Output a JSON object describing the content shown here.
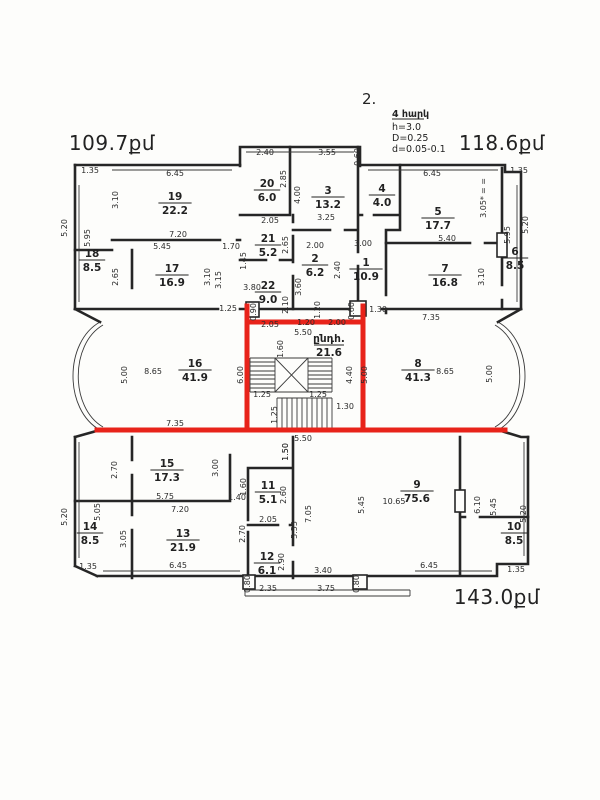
{
  "meta": {
    "floor_mark": "2."
  },
  "notes": {
    "title": "4 հարկ",
    "line_h": "h=3.0",
    "line_D": "D=0.25",
    "line_d": "d=0.05-0.1"
  },
  "hall": {
    "num": "ընդհ.",
    "area": "21.6"
  },
  "colors": {
    "ink": "#262626",
    "highlight_red": "#e8231a",
    "paper": "#fdfdfb"
  },
  "area_labels": [
    {
      "text": "109.7քմ",
      "x": 112,
      "y": 150
    },
    {
      "text": "118.6քմ",
      "x": 502,
      "y": 150
    },
    {
      "text": "143.0քմ",
      "x": 497,
      "y": 604
    }
  ],
  "rooms": [
    {
      "num": "19",
      "area": "22.2",
      "x": 175,
      "y": 203
    },
    {
      "num": "20",
      "area": "6.0",
      "x": 267,
      "y": 190
    },
    {
      "num": "3",
      "area": "13.2",
      "x": 328,
      "y": 197
    },
    {
      "num": "4",
      "area": "4.0",
      "x": 382,
      "y": 195
    },
    {
      "num": "5",
      "area": "17.7",
      "x": 438,
      "y": 218
    },
    {
      "num": "18",
      "area": "8.5",
      "x": 92,
      "y": 260
    },
    {
      "num": "17",
      "area": "16.9",
      "x": 172,
      "y": 275
    },
    {
      "num": "21",
      "area": "5.2",
      "x": 268,
      "y": 245
    },
    {
      "num": "2",
      "area": "6.2",
      "x": 315,
      "y": 265
    },
    {
      "num": "1",
      "area": "10.9",
      "x": 366,
      "y": 269
    },
    {
      "num": "7",
      "area": "16.8",
      "x": 445,
      "y": 275
    },
    {
      "num": "6",
      "area": "8.5",
      "x": 515,
      "y": 258
    },
    {
      "num": "22",
      "area": "9.0",
      "x": 268,
      "y": 292
    },
    {
      "num": "16",
      "area": "41.9",
      "x": 195,
      "y": 370
    },
    {
      "num": "8",
      "area": "41.3",
      "x": 418,
      "y": 370
    },
    {
      "num": "15",
      "area": "17.3",
      "x": 167,
      "y": 470
    },
    {
      "num": "11",
      "area": "5.1",
      "x": 268,
      "y": 492
    },
    {
      "num": "9",
      "area": "75.6",
      "x": 417,
      "y": 491
    },
    {
      "num": "14",
      "area": "8.5",
      "x": 90,
      "y": 533
    },
    {
      "num": "13",
      "area": "21.9",
      "x": 183,
      "y": 540
    },
    {
      "num": "12",
      "area": "6.1",
      "x": 267,
      "y": 563
    },
    {
      "num": "10",
      "area": "8.5",
      "x": 514,
      "y": 533
    }
  ],
  "dims": [
    {
      "t": "1.35",
      "x": 90,
      "y": 173
    },
    {
      "t": "6.45",
      "x": 175,
      "y": 176
    },
    {
      "t": "3.10",
      "x": 118,
      "y": 200,
      "r": 1
    },
    {
      "t": "5.20",
      "x": 67,
      "y": 228,
      "r": 1
    },
    {
      "t": "7.20",
      "x": 178,
      "y": 237
    },
    {
      "t": "5.95",
      "x": 90,
      "y": 238,
      "r": 1
    },
    {
      "t": "5.45",
      "x": 162,
      "y": 249
    },
    {
      "t": "1.70",
      "x": 231,
      "y": 249
    },
    {
      "t": "2.65",
      "x": 118,
      "y": 277,
      "r": 1
    },
    {
      "t": "3.10",
      "x": 210,
      "y": 277,
      "r": 1
    },
    {
      "t": "3.15",
      "x": 221,
      "y": 280,
      "r": 1
    },
    {
      "t": "2.40",
      "x": 265,
      "y": 155
    },
    {
      "t": "3.55",
      "x": 327,
      "y": 155
    },
    {
      "t": "0.60",
      "x": 360,
      "y": 157,
      "r": 1
    },
    {
      "t": "2.85",
      "x": 286,
      "y": 179,
      "r": 1
    },
    {
      "t": "4.00",
      "x": 300,
      "y": 195,
      "r": 1
    },
    {
      "t": "2.05",
      "x": 270,
      "y": 223
    },
    {
      "t": "3.25",
      "x": 326,
      "y": 220
    },
    {
      "t": "2.65",
      "x": 288,
      "y": 245,
      "r": 1
    },
    {
      "t": "2.00",
      "x": 315,
      "y": 248
    },
    {
      "t": "3.00",
      "x": 363,
      "y": 246
    },
    {
      "t": "1.45",
      "x": 246,
      "y": 261,
      "r": 1
    },
    {
      "t": "3.80",
      "x": 252,
      "y": 290
    },
    {
      "t": "2.40",
      "x": 340,
      "y": 270,
      "r": 1
    },
    {
      "t": "3.60",
      "x": 301,
      "y": 287,
      "r": 1
    },
    {
      "t": "2.10",
      "x": 288,
      "y": 305,
      "r": 1
    },
    {
      "t": "1.20",
      "x": 320,
      "y": 310,
      "r": 1
    },
    {
      "t": "1.25",
      "x": 228,
      "y": 311
    },
    {
      "t": "0.90",
      "x": 256,
      "y": 312,
      "r": 1
    },
    {
      "t": "0.60",
      "x": 354,
      "y": 311,
      "r": 1
    },
    {
      "t": "2.05",
      "x": 270,
      "y": 327
    },
    {
      "t": "1.20",
      "x": 306,
      "y": 325
    },
    {
      "t": "2.00",
      "x": 337,
      "y": 325
    },
    {
      "t": "1.30",
      "x": 378,
      "y": 312
    },
    {
      "t": "6.45",
      "x": 432,
      "y": 176
    },
    {
      "t": "1.35",
      "x": 519,
      "y": 173
    },
    {
      "t": "= =",
      "x": 486,
      "y": 186,
      "r": 1
    },
    {
      "t": "3.05*",
      "x": 486,
      "y": 207,
      "r": 1
    },
    {
      "t": "5.20",
      "x": 528,
      "y": 225,
      "r": 1
    },
    {
      "t": "5.95",
      "x": 510,
      "y": 235,
      "r": 1
    },
    {
      "t": "5.40",
      "x": 447,
      "y": 241
    },
    {
      "t": "3.10",
      "x": 484,
      "y": 277,
      "r": 1
    },
    {
      "t": "7.35",
      "x": 431,
      "y": 320
    },
    {
      "t": "5.50",
      "x": 303,
      "y": 335
    },
    {
      "t": "1.60",
      "x": 283,
      "y": 349,
      "r": 1
    },
    {
      "t": "6.00",
      "x": 243,
      "y": 375,
      "r": 1
    },
    {
      "t": "5.00",
      "x": 127,
      "y": 375,
      "r": 1
    },
    {
      "t": "8.65",
      "x": 153,
      "y": 374
    },
    {
      "t": "5.00",
      "x": 367,
      "y": 375,
      "r": 1
    },
    {
      "t": "4.40",
      "x": 352,
      "y": 375,
      "r": 1
    },
    {
      "t": "8.65",
      "x": 445,
      "y": 374
    },
    {
      "t": "5.00",
      "x": 492,
      "y": 374,
      "r": 1
    },
    {
      "t": "1.25",
      "x": 262,
      "y": 397
    },
    {
      "t": "1.25",
      "x": 318,
      "y": 397
    },
    {
      "t": "1.25",
      "x": 277,
      "y": 415,
      "r": 1
    },
    {
      "t": "1.30",
      "x": 345,
      "y": 409
    },
    {
      "t": "7.35",
      "x": 175,
      "y": 426
    },
    {
      "t": "5.50",
      "x": 303,
      "y": 441
    },
    {
      "t": "1.50",
      "x": 288,
      "y": 452,
      "r": 1
    },
    {
      "t": "2.70",
      "x": 117,
      "y": 470,
      "r": 1
    },
    {
      "t": "3.00",
      "x": 218,
      "y": 468,
      "r": 1
    },
    {
      "t": "5.75",
      "x": 165,
      "y": 499
    },
    {
      "t": "1.40",
      "x": 237,
      "y": 500
    },
    {
      "t": "1.60",
      "x": 246,
      "y": 487,
      "r": 1
    },
    {
      "t": "5.20",
      "x": 67,
      "y": 517,
      "r": 1
    },
    {
      "t": "5.05",
      "x": 100,
      "y": 512,
      "r": 1
    },
    {
      "t": "7.20",
      "x": 180,
      "y": 512
    },
    {
      "t": "3.05",
      "x": 126,
      "y": 539,
      "r": 1
    },
    {
      "t": "2.70",
      "x": 245,
      "y": 534,
      "r": 1
    },
    {
      "t": "6.45",
      "x": 178,
      "y": 568
    },
    {
      "t": "1.35",
      "x": 88,
      "y": 569
    },
    {
      "t": "1.50",
      "x": 288,
      "y": 452,
      "r": 1
    },
    {
      "t": "2.60",
      "x": 286,
      "y": 495,
      "r": 1
    },
    {
      "t": "2.05",
      "x": 268,
      "y": 522
    },
    {
      "t": "5.55",
      "x": 297,
      "y": 530,
      "r": 1
    },
    {
      "t": "7.05",
      "x": 311,
      "y": 514,
      "r": 1
    },
    {
      "t": "2.90",
      "x": 284,
      "y": 562,
      "r": 1
    },
    {
      "t": "3.40",
      "x": 323,
      "y": 573
    },
    {
      "t": "2.35",
      "x": 268,
      "y": 591
    },
    {
      "t": "3.75",
      "x": 326,
      "y": 591
    },
    {
      "t": "0.80",
      "x": 250,
      "y": 584,
      "r": 1
    },
    {
      "t": "0.80",
      "x": 359,
      "y": 584,
      "r": 1
    },
    {
      "t": "5.45",
      "x": 364,
      "y": 505,
      "r": 1
    },
    {
      "t": "10.65",
      "x": 394,
      "y": 504
    },
    {
      "t": "6.10",
      "x": 480,
      "y": 505,
      "r": 1
    },
    {
      "t": "5.45",
      "x": 496,
      "y": 507,
      "r": 1
    },
    {
      "t": "5.20",
      "x": 526,
      "y": 514,
      "r": 1
    },
    {
      "t": "6.45",
      "x": 429,
      "y": 568
    },
    {
      "t": "1.35",
      "x": 516,
      "y": 572
    }
  ]
}
